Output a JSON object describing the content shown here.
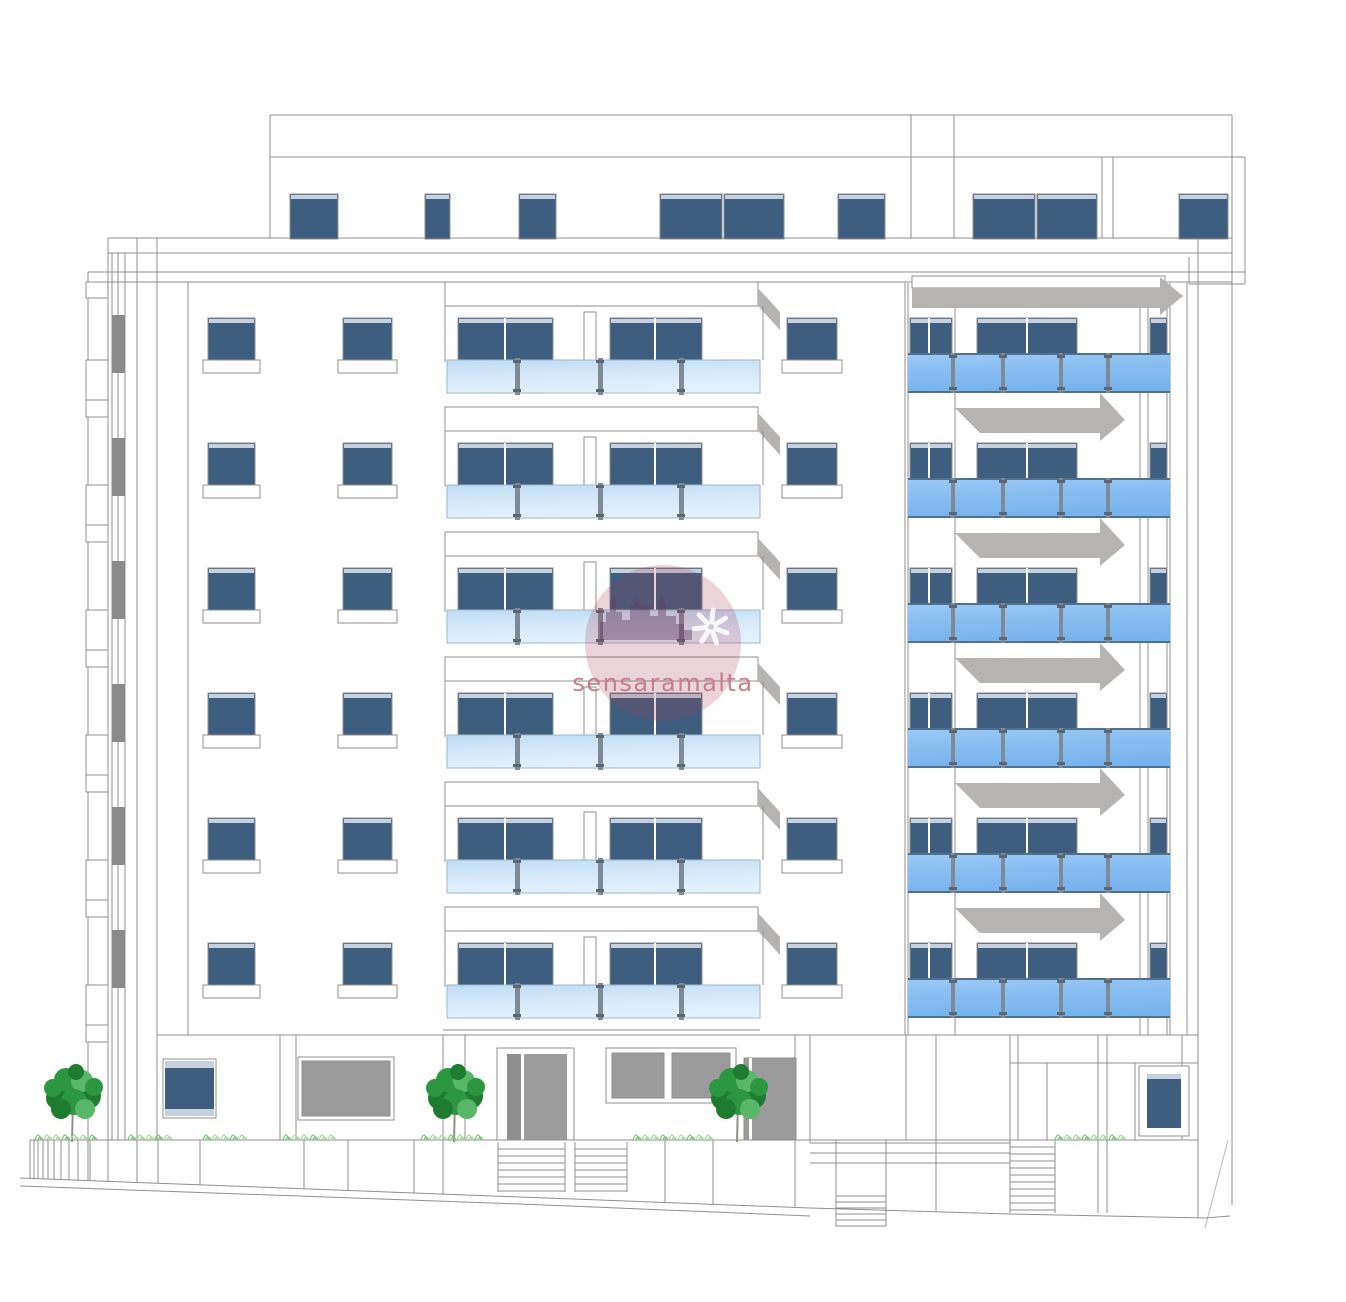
{
  "watermark": {
    "text": "sensaramalta",
    "cx": 663,
    "cy": 643,
    "r": 78,
    "text_y": 691,
    "font_size": 24,
    "circle_color": "rgba(166,60,82,0.22)",
    "skyline_color": "rgba(96,62,102,0.45)",
    "star_color": "rgba(255,255,255,0.85)",
    "text_color": "rgba(198,120,136,0.95)"
  },
  "palette": {
    "line": "#8f8f8f",
    "line_faint": "#b9b9b9",
    "window_blue": "#3e5e80",
    "window_top_edge": "#c5d1de",
    "glass_light_top": "#bfdcf5",
    "glass_light_bottom": "#e3f1fd",
    "glass_bright_top": "#9ccaf6",
    "glass_bright_bottom": "#77b3ec",
    "glass_rail": "#51708c",
    "post_gray": "#7e8a96",
    "clamp_gray": "#5a6673",
    "shadow_gray": "#b5b4b2",
    "door_gray_dark": "#8e8e8e",
    "door_gray_mid": "#9c9c9c",
    "panel_gray": "#9b9b9b",
    "pipe_gray": "#8a8a8a",
    "tree_dark": "#1d7c30",
    "tree_mid": "#2c9640",
    "tree_light": "#58b868",
    "trunk": "#8a977f",
    "shrub_green": "#a9d6a2",
    "shrub_dark": "#7cc27c",
    "roof_shape": "#6e6054",
    "white": "#ffffff"
  },
  "building": {
    "floors": 6,
    "row_pitch": 125,
    "first_window_row_y": 318,
    "penthouse_windows_x_w": [
      [
        290,
        48
      ],
      [
        425,
        25
      ],
      [
        519,
        37
      ],
      [
        660,
        62
      ],
      [
        724,
        60
      ],
      [
        838,
        47
      ],
      [
        973,
        62
      ],
      [
        1037,
        60
      ],
      [
        1179,
        49
      ]
    ],
    "left_window_columns_x_w": [
      [
        208,
        47
      ],
      [
        343,
        49
      ]
    ],
    "mid_window_column_x_w": [
      787,
      50
    ],
    "center_balcony": {
      "x": 445,
      "width": 313,
      "window_pairs": [
        [
          458,
          95,
          505
        ],
        [
          610,
          92,
          655
        ]
      ],
      "posts_x": [
        517,
        600,
        681
      ]
    },
    "right_balcony": {
      "x": 908,
      "width": 262,
      "windows": [
        [
          910,
          42,
          929
        ],
        [
          977,
          100,
          1027
        ],
        [
          1150,
          17,
          0
        ]
      ],
      "posts_x": [
        953,
        1003,
        1061,
        1108
      ]
    }
  },
  "trees_x": [
    74,
    456,
    739
  ],
  "shrub_clusters": [
    [
      35,
      95
    ],
    [
      128,
      175
    ],
    [
      203,
      246
    ],
    [
      283,
      340
    ],
    [
      421,
      485
    ],
    [
      633,
      713
    ],
    [
      1055,
      1130
    ]
  ]
}
